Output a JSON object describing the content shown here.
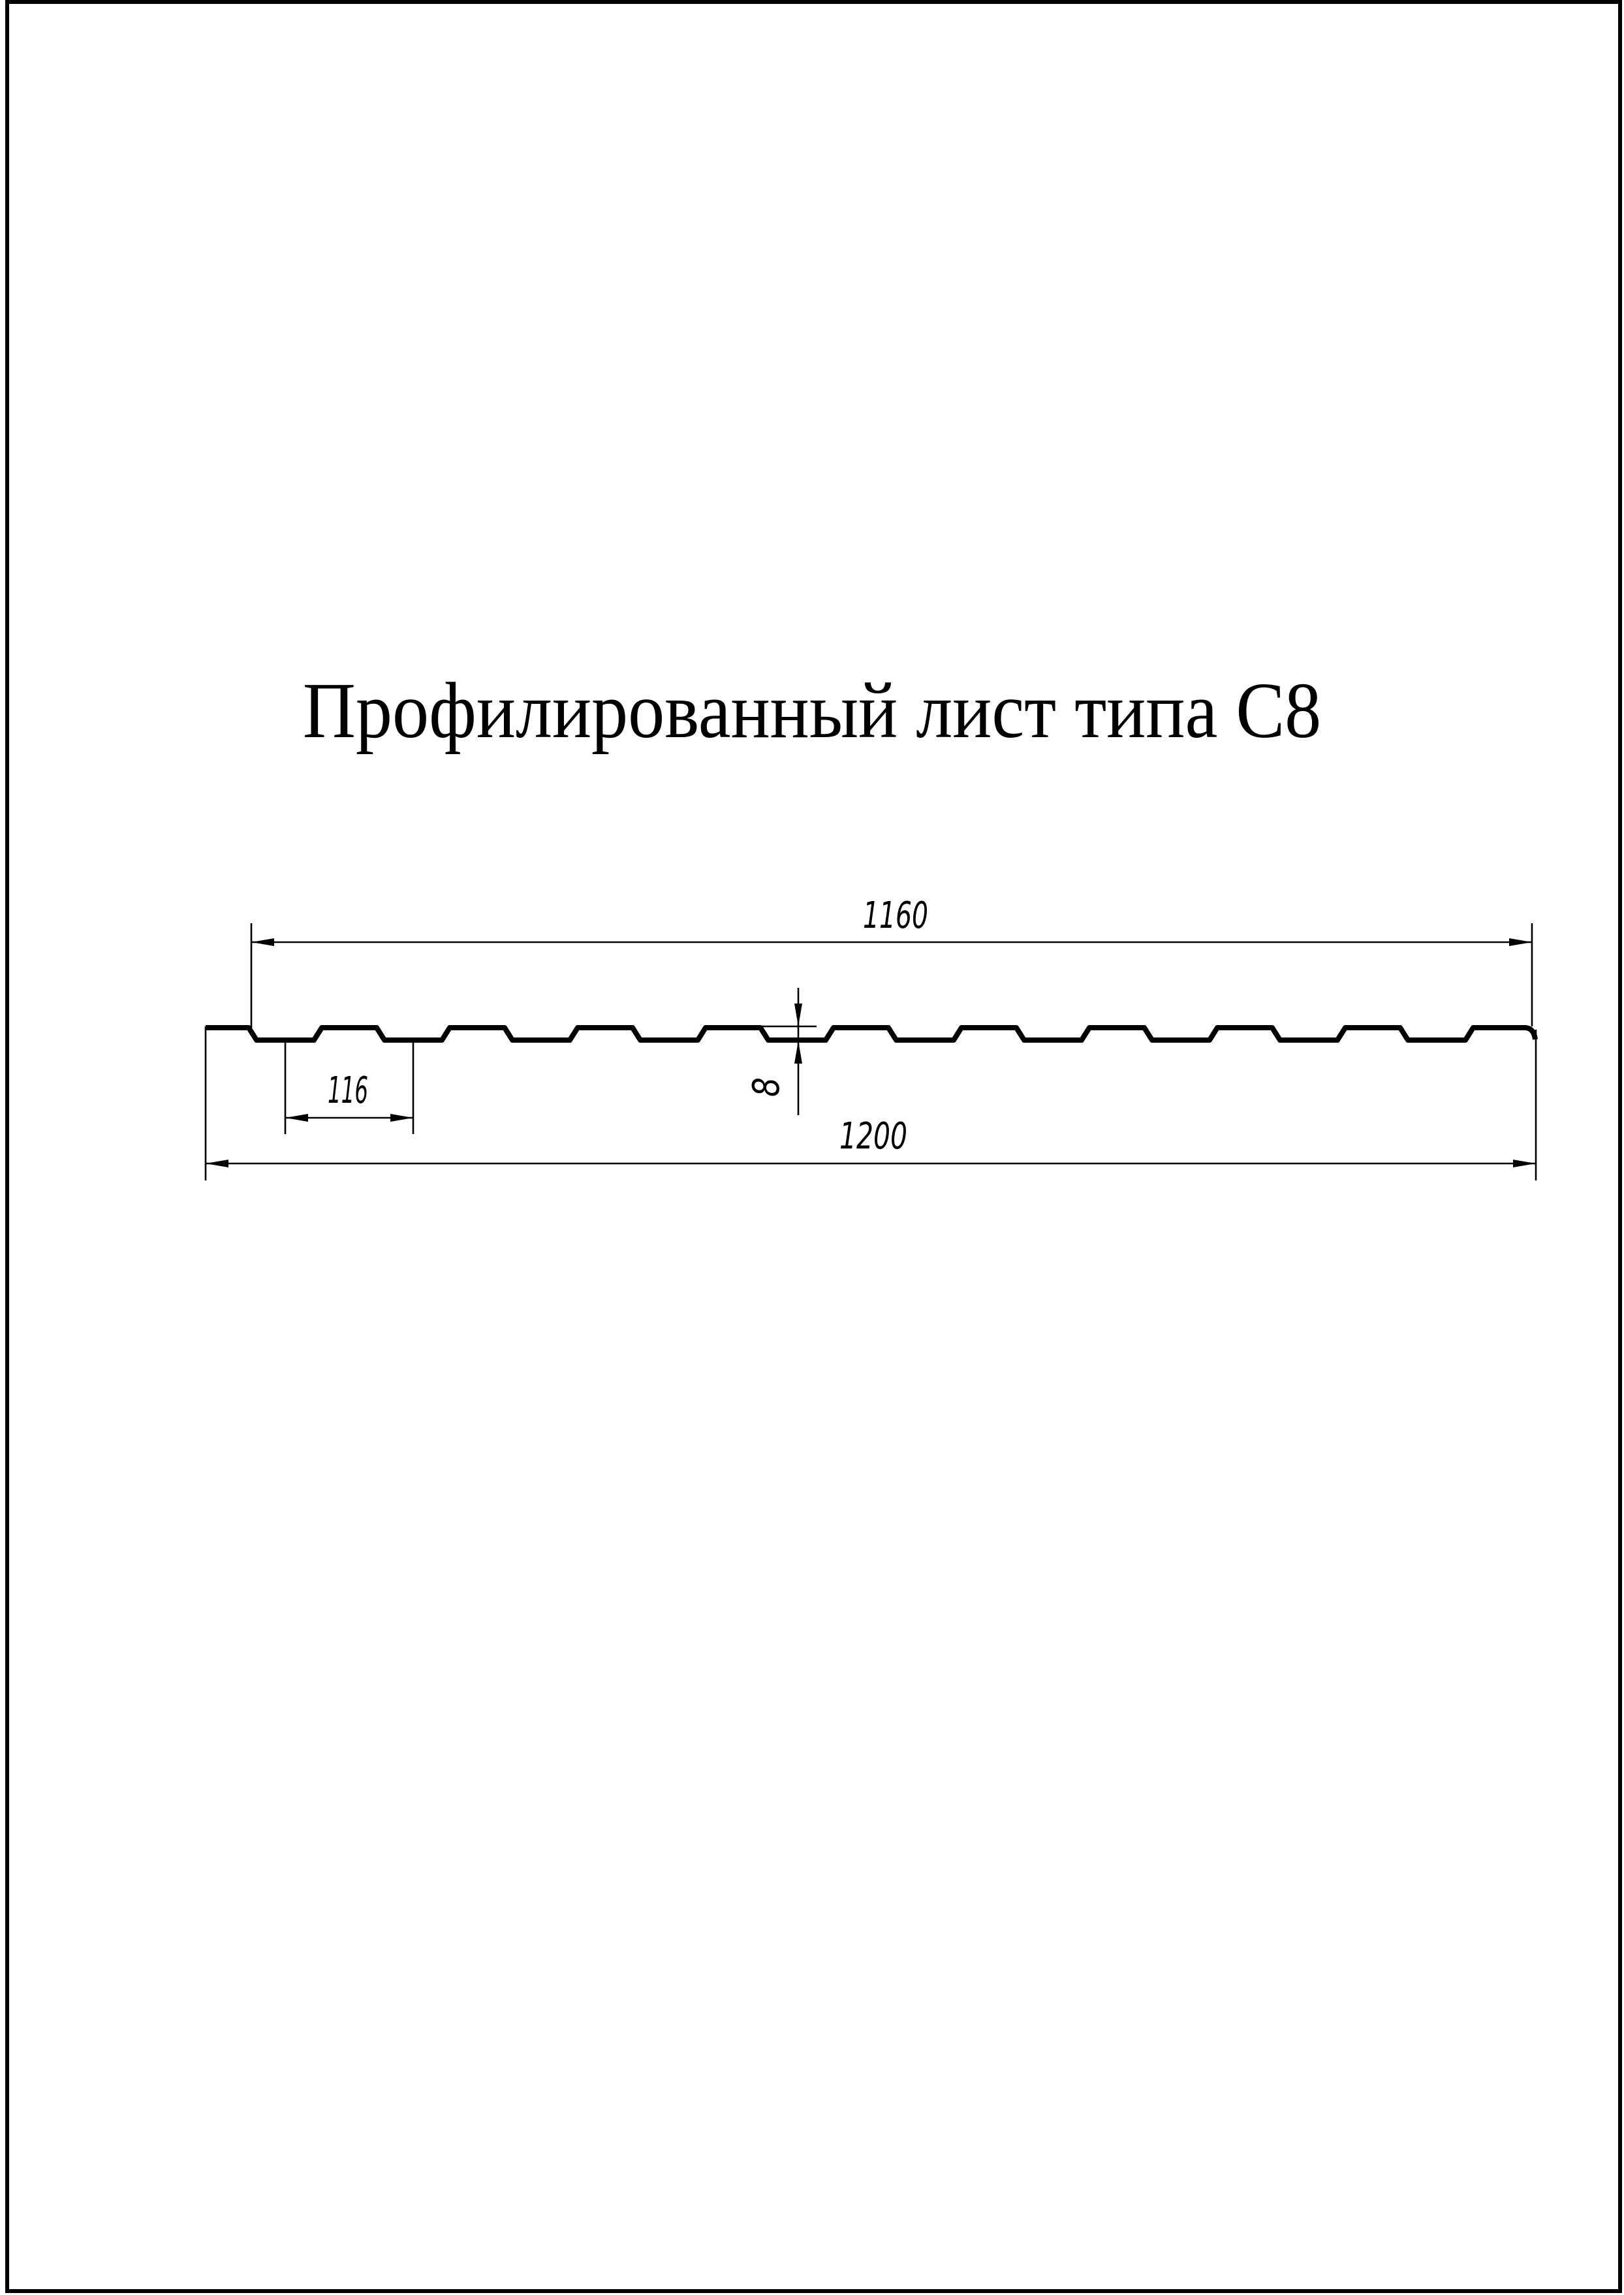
{
  "page": {
    "title": "Профилированный лист типа С8"
  },
  "colors": {
    "ink": "#000000",
    "paper": "#ffffff"
  },
  "drawing": {
    "type": "profile-sheet-cross-section",
    "dimensions": {
      "working_width": "1160",
      "rib_pitch": "116",
      "profile_height": "8",
      "overall_width": "1200"
    }
  }
}
